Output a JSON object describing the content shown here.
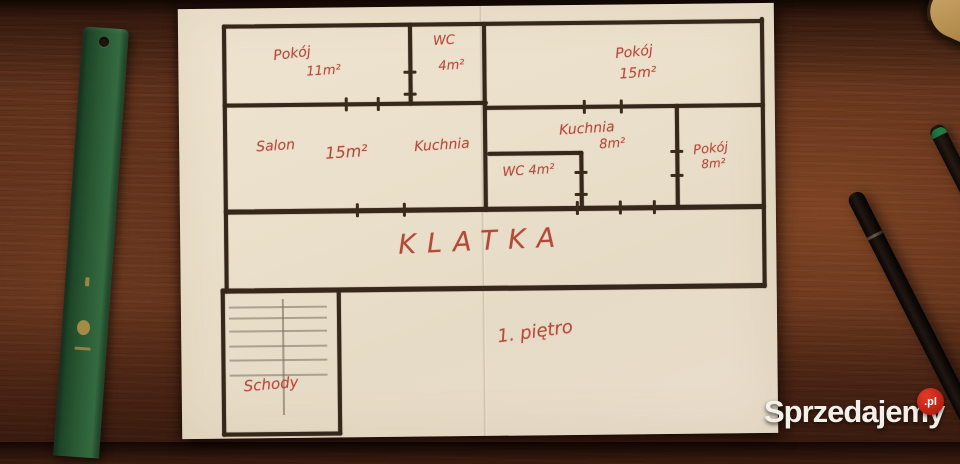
{
  "floorplan": {
    "floor_label": "1. piętro",
    "hall": {
      "label": "KLATKA"
    },
    "stairs": {
      "label": "Schody"
    },
    "rooms": {
      "pokoj_top_left": {
        "name": "Pokój",
        "area": "11m²"
      },
      "wc_top": {
        "name": "WC",
        "area": "4m²"
      },
      "pokoj_top_right": {
        "name": "Pokój",
        "area": "15m²"
      },
      "salon": {
        "name": "Salon",
        "area": "15m²"
      },
      "kuchnia_open": {
        "name": "Kuchnia"
      },
      "kuchnia_right": {
        "name": "Kuchnia",
        "area": "8m²"
      },
      "wc_mid": {
        "name": "WC",
        "area": "4m²"
      },
      "pokoj_right": {
        "name": "Pokój",
        "area": "8m²"
      }
    }
  },
  "watermark": {
    "brand": "Sprzedajemy",
    "tld": ".pl"
  },
  "colors": {
    "ink_red": "#b84a3c",
    "wall_dark": "#352719",
    "paper": "#e9dfca",
    "ruler_green": "#2a5c36",
    "wood_brown": "#5d301b",
    "badge_red": "#b51b10"
  }
}
